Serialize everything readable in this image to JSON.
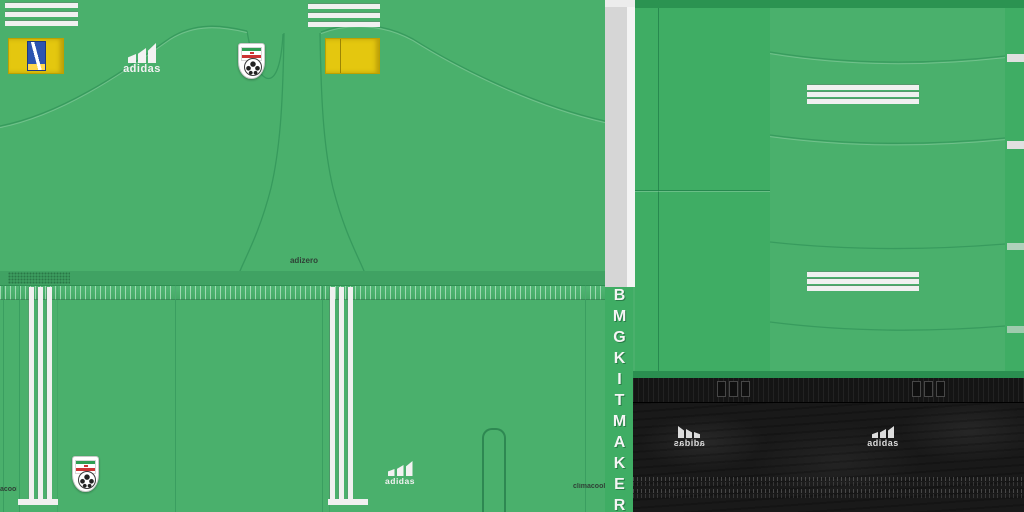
{
  "texts": {
    "adidas_wordmark": "adidas",
    "adizero": "adizero",
    "climacool": "climacool",
    "climacool_partial": "acool",
    "maker_tag": "BMGKITMAKER"
  },
  "colors": {
    "base_green": "#4ab06c",
    "panel_green": "#3fad64",
    "dark_band_green": "#2b9351",
    "stripe_white": "#f0f0f0",
    "gray_strip": "#d6d6d6",
    "patch_yellow": "#e4c70f",
    "patch_emblem_blue": "#2c54b0",
    "sock_black": "#191919",
    "flag_green": "#2f9e53",
    "flag_red": "#cc3333"
  },
  "icons": {
    "adidas_bars": "adidas three-bar performance logo",
    "iran_badge": "Iran football federation crest with soccer ball",
    "three_stripes": "adidas three stripes"
  }
}
